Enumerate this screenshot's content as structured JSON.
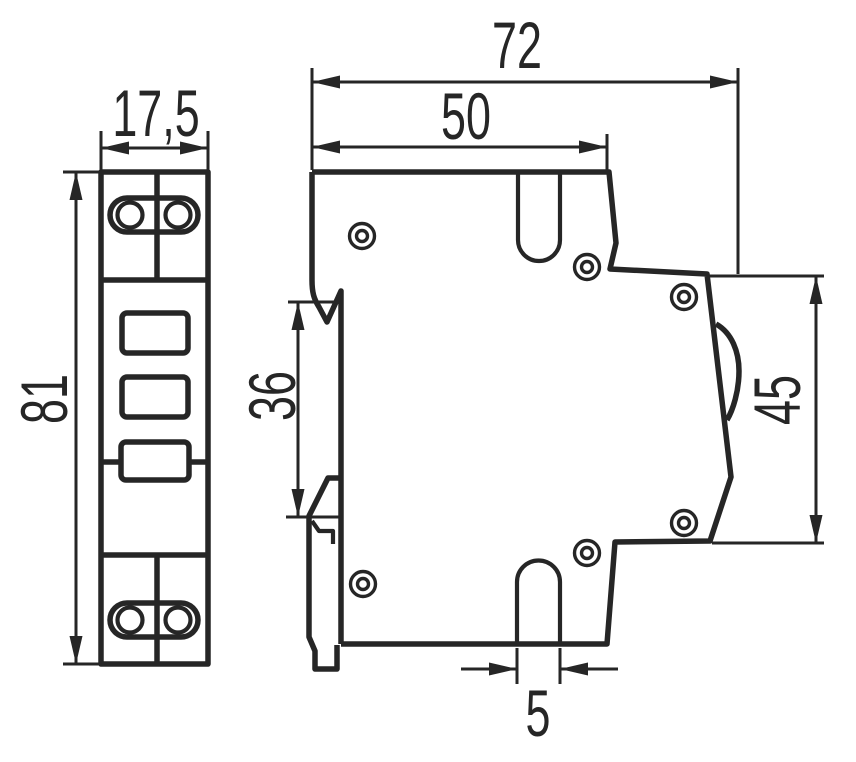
{
  "drawing": {
    "kind": "technical-dimension-drawing",
    "subject": "DIN-rail modular device, front and side views",
    "line_color": "#262626",
    "background_color": "#ffffff"
  },
  "dimensions": {
    "front_width": "17,5",
    "front_height": "81",
    "side_depth_total": "72",
    "side_depth_front": "50",
    "side_rail_recess": "36",
    "side_rear_height": "45",
    "side_slot_width": "5"
  }
}
